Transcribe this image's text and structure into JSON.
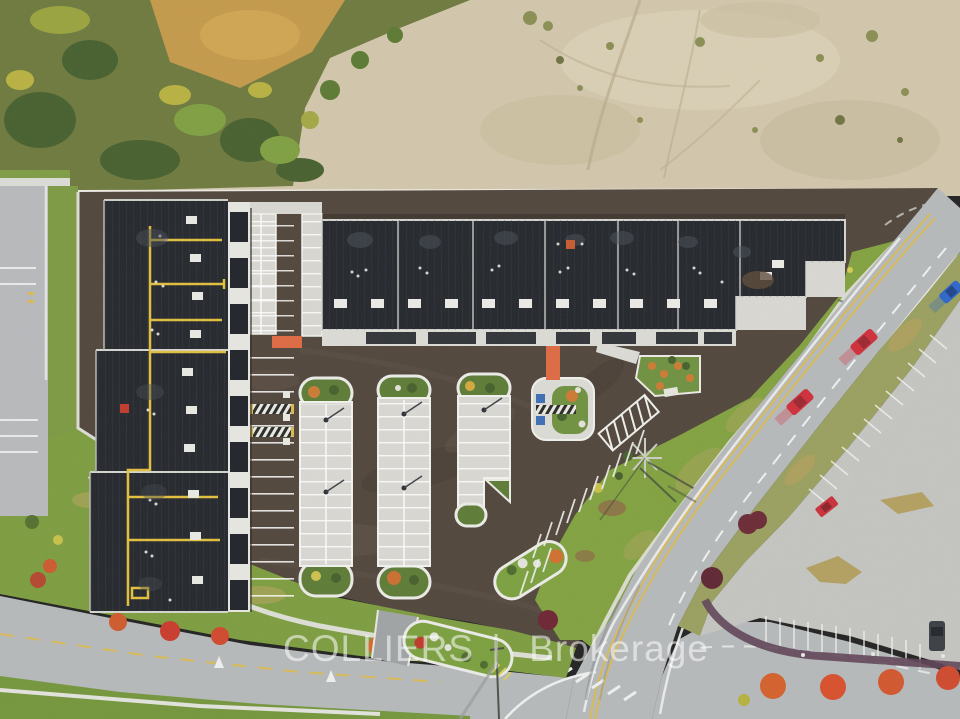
{
  "watermark": {
    "brand": "COLLIERS",
    "divider": "|",
    "suffix": "Brokerage",
    "color": "#ffffff",
    "opacity": "0.55"
  },
  "scene": {
    "type": "aerial-drone-photograph",
    "subject": "new industrial condo complex with fresh parking lots beside an arterial road, autumn",
    "areas": [
      "scrub-woodland",
      "bare-dirt-lot",
      "dark-roof-buildings",
      "concrete-parking-pads",
      "arterial-road",
      "retail-parking-lot"
    ]
  },
  "objects": {
    "buildings": [
      {
        "name": "west-building",
        "roofSections": 3,
        "rooftop": [
          "yellow-gas-piping",
          "roof-hatches",
          "vents",
          "red-unit"
        ]
      },
      {
        "name": "north-building",
        "roofSections": 6,
        "rooftop": [
          "roof-hatches",
          "vents",
          "orange-vent",
          "stain"
        ]
      }
    ],
    "parkingPads": 3,
    "accessibleStallMarkers": 2,
    "orangeCrosswalks": 2,
    "vehicles": {
      "movingRedCars": 2,
      "movingBlueCars": 1,
      "parkedRedCars": 1,
      "parkedDarkCars": 1
    },
    "autumnTrees": "red and orange trees along roads and medians",
    "utilityPylon": 1
  },
  "palette": {
    "roofDark": "#24272c",
    "siteAsphalt": "#51463c",
    "concretePad": "#d8d7d2",
    "road": "#b6b9bb",
    "rightLot": "#c4c5c1",
    "grass": "#82a240",
    "verge": "#7d9d40",
    "dirt": "#d2c7ac",
    "scrub": "#6e7a3e",
    "fallRed": "#c93b2c",
    "fallOrange": "#d2692e",
    "pipeYellow": "#e2bf3d",
    "crosswalkOrange": "#de6a43",
    "carRed": "#cf2f3a",
    "carBlue": "#2e66c8",
    "watermark": "#ffffff"
  }
}
